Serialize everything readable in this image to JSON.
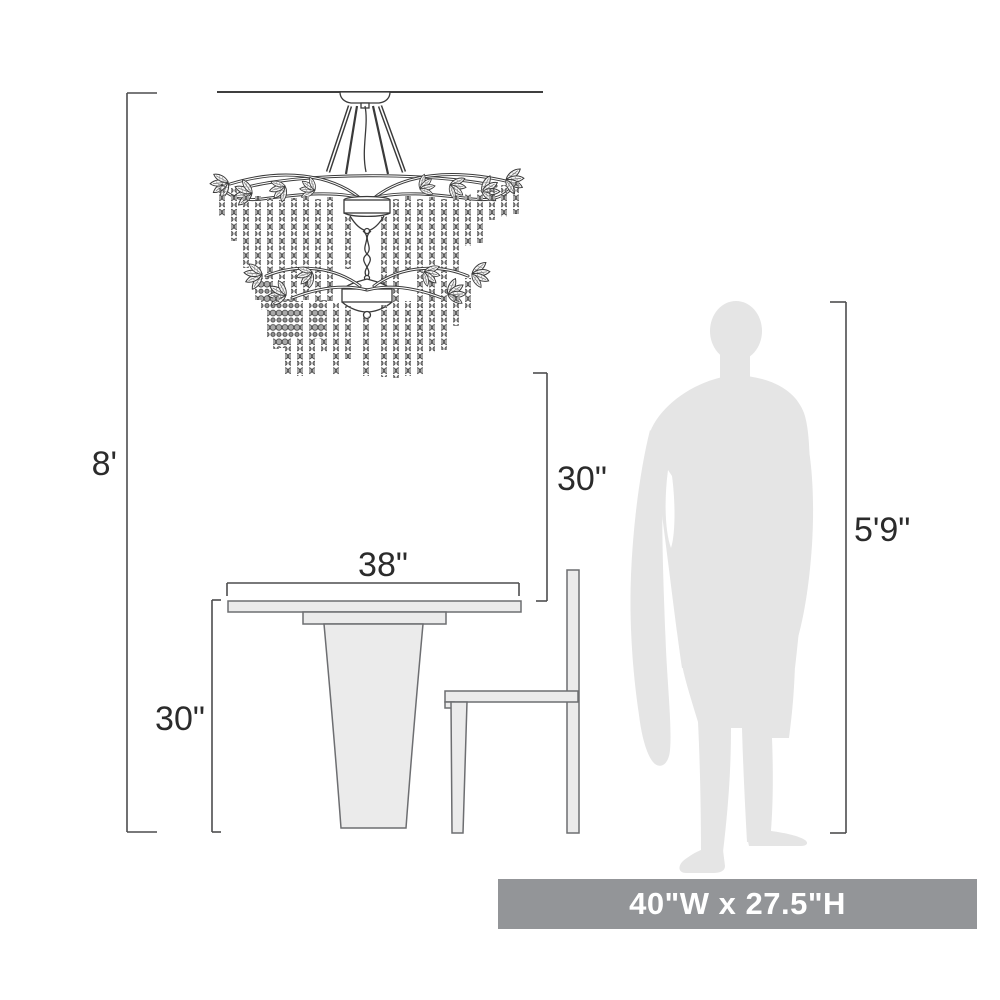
{
  "labels": {
    "ceiling_height": "8'",
    "fixture_to_table": "30\"",
    "table_width": "38\"",
    "table_height": "30\"",
    "person_height": "5'9\""
  },
  "banner": {
    "fixture_size": "40\"W x 27.5\"H"
  },
  "objects": {
    "fixture": "chandelier-line-drawing",
    "furniture": "pedestal-dining-table-with-chair",
    "figure": "standing-person-silhouette"
  },
  "colors": {
    "line": "#4d4d4e",
    "text": "#2b2b2b",
    "silhouette": "#e5e5e5",
    "furniture_fill": "#ebebeb",
    "furniture_stroke": "#6d6e71",
    "banner_bg": "#939598",
    "banner_text": "#ffffff"
  }
}
